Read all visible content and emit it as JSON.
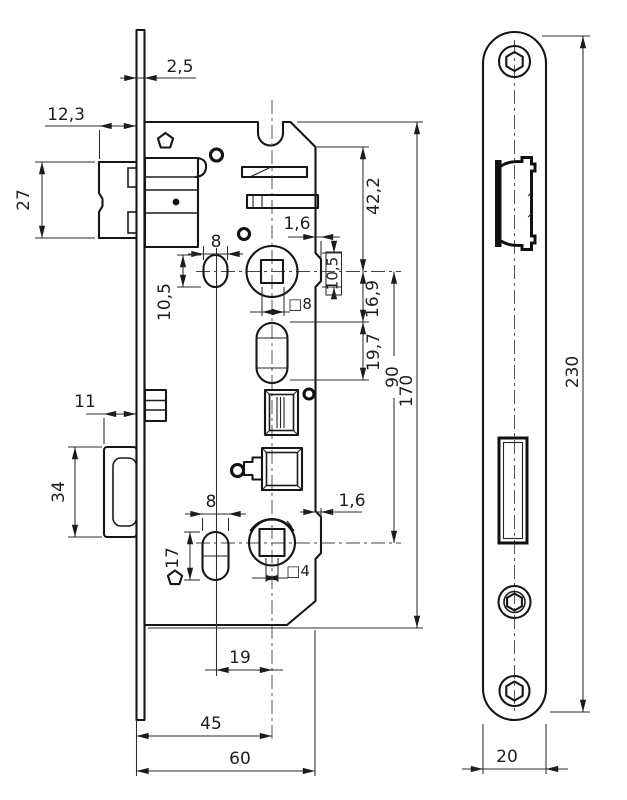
{
  "drawing": {
    "kind": "mortise-lock-technical-drawing",
    "ink_color": "#1b1b1b",
    "background_color": "#ffffff",
    "front_view": {
      "dims": {
        "plate_thickness": "2,5",
        "latch_protrusion": "12,3",
        "latch_height": "27",
        "latch_slot_width": "8",
        "latch_slot_height": "10,5",
        "handle_square": "□8",
        "edge_step_top": "1,6",
        "follower_height_ref": "10,5",
        "shoulder_to_handle": "42,2",
        "handle_to_slot": "16,9",
        "slot_length": "19,7",
        "handle_to_key": "90",
        "case_height": "170",
        "bolt_protrusion": "11",
        "bolt_height": "34",
        "key_slot_width": "8",
        "key_slot_height": "17",
        "key_square": "□4",
        "edge_step_bottom": "1,6",
        "slot_offset": "19",
        "backset": "45",
        "case_depth": "60"
      }
    },
    "side_view": {
      "dims": {
        "plate_length": "230",
        "plate_width": "20"
      }
    }
  }
}
